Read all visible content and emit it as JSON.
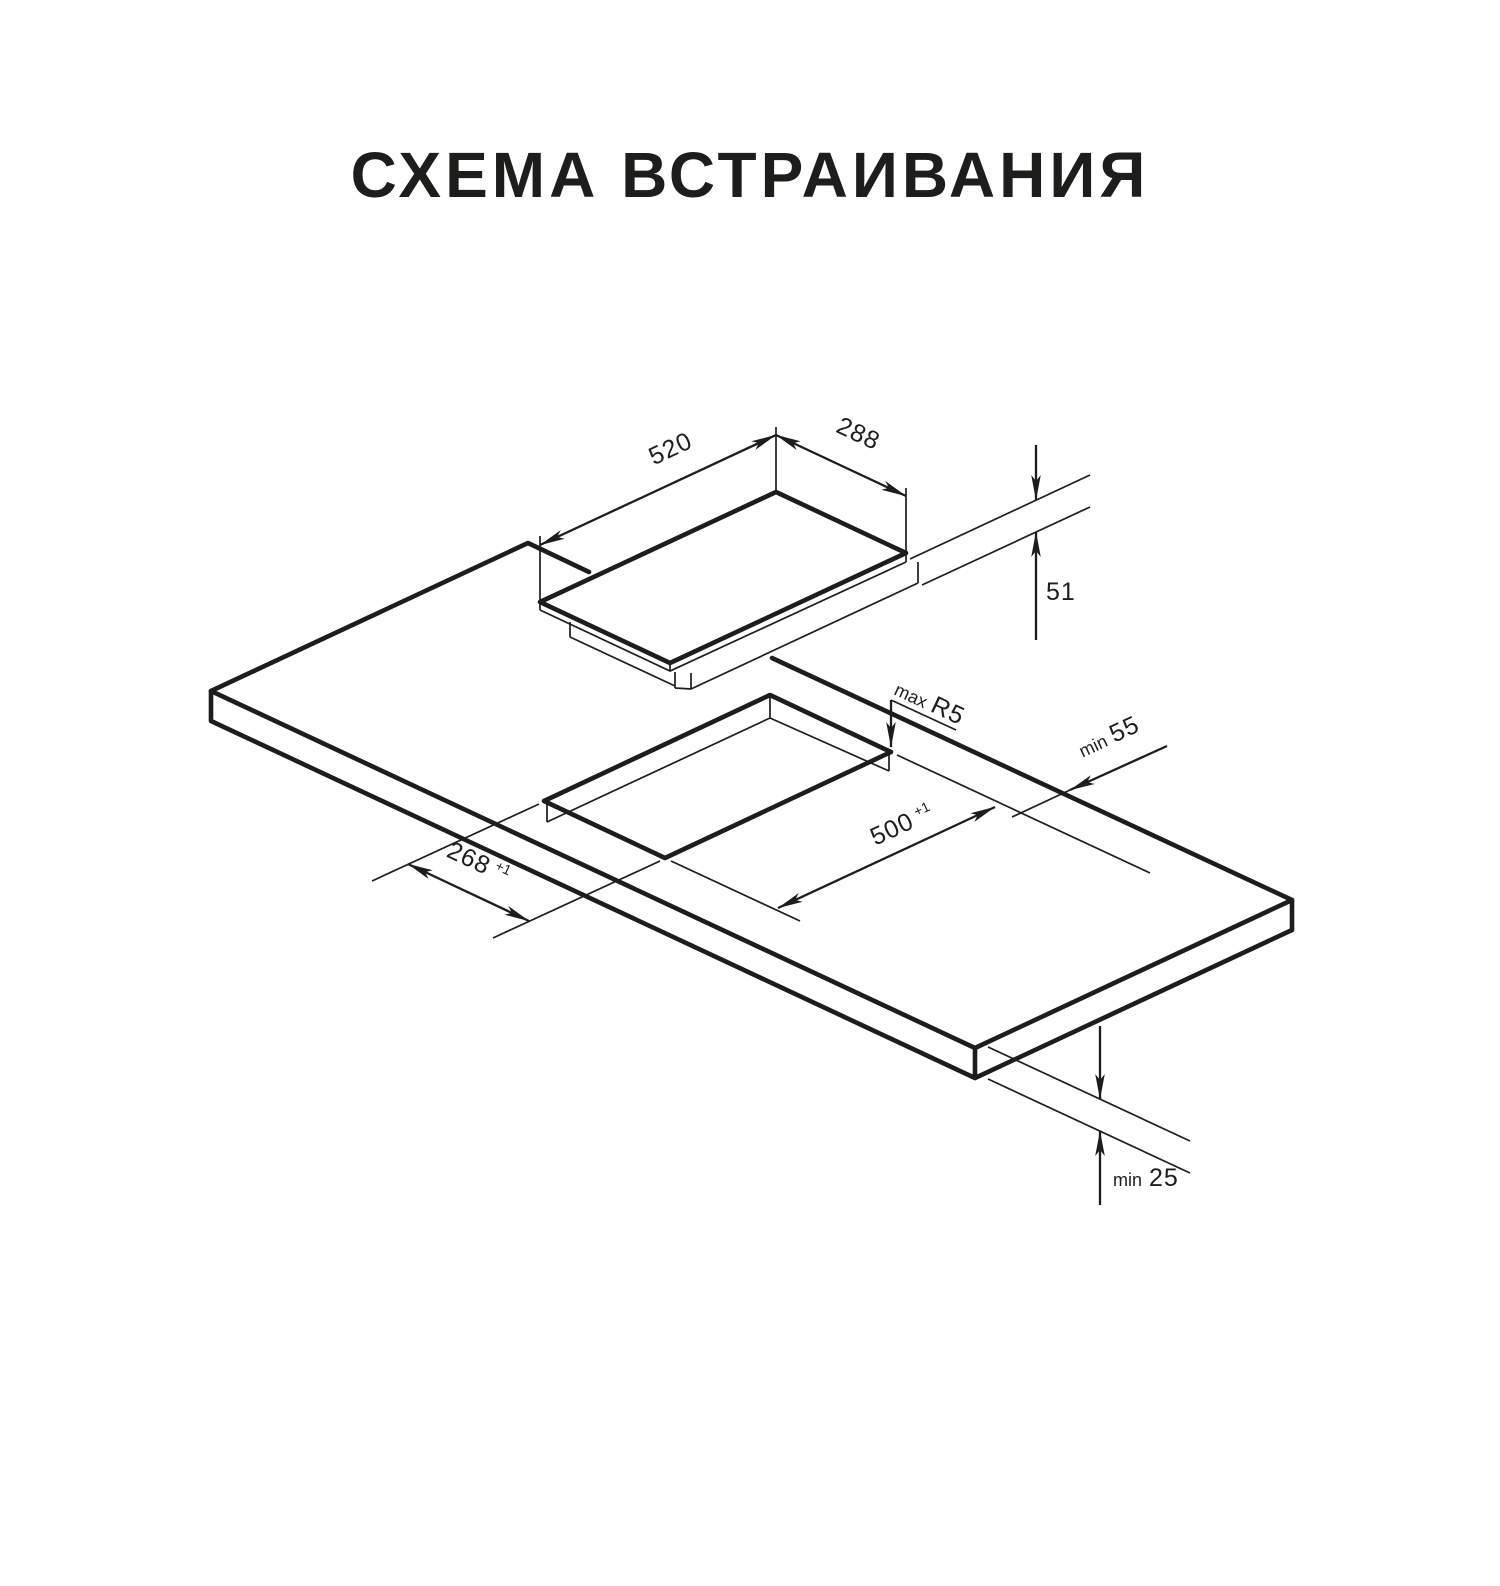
{
  "title": "СХЕМА ВСТРАИВАНИЯ",
  "colors": {
    "background": "#ffffff",
    "line": "#1d1d1b"
  },
  "diagram_type": "isometric built-in hob installation drawing",
  "dimensions": {
    "hob_width": {
      "value": "520"
    },
    "hob_depth": {
      "value": "288"
    },
    "hob_height": {
      "value": "51"
    },
    "cutout_length": {
      "value": "500",
      "tolerance": "+1"
    },
    "cutout_width": {
      "value": "268",
      "tolerance": "+1"
    },
    "cutout_corner_radius": {
      "prefix": "max",
      "value": "R5"
    },
    "rear_clearance": {
      "prefix": "min",
      "value": "55"
    },
    "bottom_clearance": {
      "prefix": "min",
      "value": "25"
    }
  }
}
